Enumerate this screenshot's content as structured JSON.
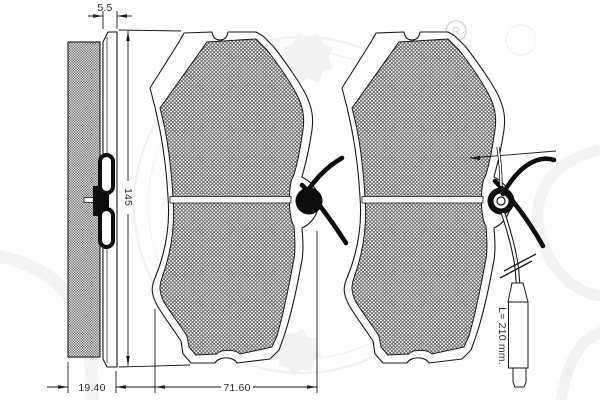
{
  "drawing": {
    "registered_mark": "R",
    "line_color": "#1a1a1a",
    "friction_hatch_color": "#555555",
    "watermark_color": "#999999",
    "dimensions": {
      "plate_thickness": "5.5",
      "pad_total_thickness": "19.40",
      "pad_height": "145",
      "pad_width": "71.60",
      "indicator_lead_length": "L= 210 mm."
    }
  }
}
